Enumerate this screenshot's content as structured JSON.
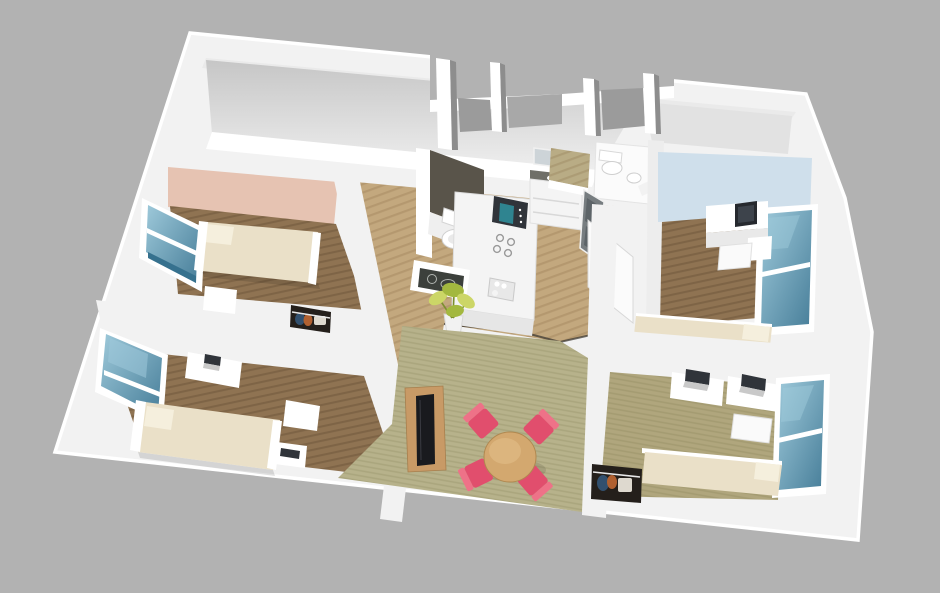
{
  "meta": {
    "description": "3D cutaway architectural rendering of a four-bedroom apartment floor plan viewed from above at an angle, on a plain gray background. Four bedrooms with single beds, desks and windows surround a central kitchen, bathroom and toilet, with a living-dining area containing a round wooden table, four pink chairs, a TV console and a potted plant.",
    "view": "axonometric-cutaway",
    "background": "plain gray"
  },
  "palette": {
    "bg": "#b2b2b2",
    "wall": "#f2f2f2",
    "wall-bright": "#ffffff",
    "wall-shade": "#dedede",
    "wall-dark": "#a8a8a8",
    "floor-wood": "#8f7352",
    "floor-wood-light": "#c3a87e",
    "floor-olive": "#b0a67d",
    "carpet": "#b7b28b",
    "accent-salmon": "#e6c3b2",
    "accent-blue": "#cfdfeb",
    "glass": "#4f86a2",
    "glass-light": "#9ec9da",
    "bed": "#eae0c8",
    "bed-light": "#f5efdd",
    "chair-pink": "#e14e6d",
    "chair-pink-light": "#ee7288",
    "table-wood": "#d3a86f",
    "console-wood": "#c89a66",
    "tv-black": "#191a1e",
    "closet-dark": "#241f1b",
    "chalkboard": "#3c403c",
    "plant-leaf": "#ccd667",
    "plant-leaf-dark": "#a3b83f",
    "appliance-dark": "#30343a",
    "appliance-screen": "#2f8490",
    "counter-top": "#6f6f68",
    "bath-wall": "#59544a",
    "clothes-orange": "#b06030",
    "clothes-blue": "#32506e"
  },
  "rooms": [
    {
      "name": "bedroom-top-left",
      "accent_wall": "salmon",
      "furniture": [
        "single-bed",
        "window",
        "nightstand-desk",
        "closet-with-clothes"
      ]
    },
    {
      "name": "bedroom-bottom-left",
      "accent_wall": "white",
      "furniture": [
        "single-bed",
        "window",
        "desk-with-laptop",
        "small-desk",
        "closet"
      ]
    },
    {
      "name": "bedroom-top-right",
      "accent_wall": "light-blue",
      "furniture": [
        "single-bed",
        "window",
        "desk-with-monitor",
        "chair",
        "under-desk-shelf"
      ]
    },
    {
      "name": "bedroom-bottom-right",
      "accent_wall": "white",
      "furniture": [
        "single-bed",
        "window",
        "desk-with-laptop",
        "desk-with-laptop",
        "chair",
        "closet-with-clothes"
      ]
    },
    {
      "name": "kitchen",
      "furniture": [
        "counter-island",
        "microwave",
        "cooktop",
        "sink",
        "vanity-with-basin",
        "mirror"
      ]
    },
    {
      "name": "bathroom",
      "furniture": [
        "toilet"
      ]
    },
    {
      "name": "toilet-room",
      "furniture": [
        "toilet",
        "hand-basin"
      ]
    },
    {
      "name": "shower-room",
      "furniture": [
        "tiled-shower"
      ]
    },
    {
      "name": "living-dining",
      "furniture": [
        "round-table",
        "pink-chair",
        "pink-chair",
        "pink-chair",
        "pink-chair",
        "tv-console",
        "flat-tv",
        "potted-plant",
        "chalkboard-panel",
        "open-door"
      ]
    }
  ]
}
